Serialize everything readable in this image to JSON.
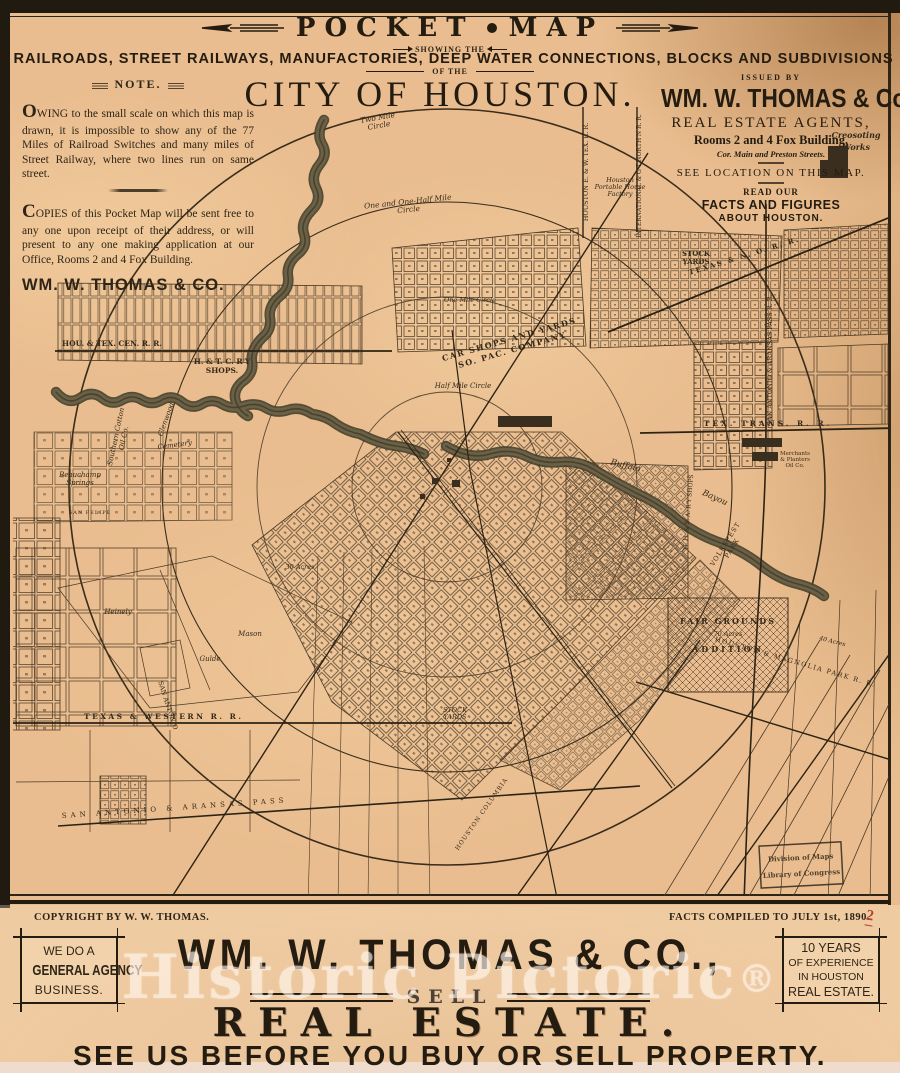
{
  "header": {
    "title_left": "POCKET",
    "title_right": "MAP",
    "showing": "SHOWING THE",
    "subtitle": "RAILROADS, STREET RAILWAYS, MANUFACTORIES, DEEP WATER CONNECTIONS, BLOCKS AND SUBDIVISIONS",
    "of_the": "OF THE",
    "city": "CITY OF HOUSTON."
  },
  "note": {
    "title": "NOTE.",
    "p1": "OWING to the small scale on which this map is drawn, it is impossible to show any of the 77 Miles of Railroad Switches and many miles of Street Railway, where two lines run on same street.",
    "p2": "COPIES of this Pocket Map will be sent free to any one upon receipt of their address, or will present to any one making application at our Office, Rooms 2 and 4 Fox Building.",
    "signature": "WM. W. THOMAS & CO."
  },
  "issuer": {
    "issued_by": "ISSUED BY",
    "name": "WM. W. THOMAS & Co.,",
    "agents": "REAL ESTATE AGENTS,",
    "rooms": "Rooms 2 and 4 Fox Building,",
    "corner": "Cor. Main and Preston Streets.",
    "see_location": "SEE LOCATION ON THIS MAP.",
    "read_our": "READ OUR",
    "facts": "FACTS AND FIGURES",
    "about": "ABOUT HOUSTON."
  },
  "map": {
    "labels": {
      "two_mile_1": "Two Mile",
      "two_mile_2": "Circle",
      "one_half_1": "One and One-Half Mile",
      "one_half_2": "Circle",
      "one_mile": "One Mile Circle",
      "half_mile": "Half Mile Circle",
      "beauchamp_1": "Beauchamp",
      "beauchamp_2": "Springs",
      "hou_tex_cen": "HOU. & TEX. CEN. R. R.",
      "htc_1": "H. & T. C. R'Y",
      "htc_2": "SHOPS.",
      "cotton_1": "Southern Cotton",
      "cotton_2": "Oil Co.",
      "glenwood": "Glenwood",
      "cemetery": "Cemetery",
      "car_1": "CAR SHOPS AND YARDS",
      "car_2": "SO. PAC. COMPANY",
      "stock_e_1": "STOCK",
      "stock_e_2": "YARDS",
      "creosoting_1": "Creosoting",
      "creosoting_2": "Works",
      "tex_trans": "TEX. TRANS. R. R.",
      "tex_no": "TEXAS & N. O. R. R.",
      "sa_ap": "SAN ANTONIO & ARANSAS PASS R. R.",
      "hou_ew": "HOUSTON E. & W. TEX. R. R.",
      "int_gn": "INTERNATIONAL & G'T NORTH'N R. R.",
      "portable_1": "Houston",
      "portable_2": "Portable House",
      "portable_3": "Factory",
      "buffalo": "Buffalo",
      "bayou": "Bayou",
      "merch_1": "Merchants",
      "merch_2": "& Planters",
      "merch_3": "Oil Co.",
      "ghsa": "G. H. & S. A. R'Y SHOPS",
      "volk_1": "VOLKSFEST",
      "volk_2": "PARK",
      "hou_mag": "HOUSTON & MAGNOLIA PARK R. R.",
      "fair_1": "FAIR GROUNDS",
      "fair_acres": "70 Acres",
      "fair_2": "ADDITION",
      "tex_west": "TEXAS & WESTERN R. R.",
      "stock_w_1": "STOCK",
      "stock_w_2": "YARDS",
      "san_antonio": "SAN ANTONIO",
      "sa_pass": "SAN ANTONIO & ARANSAS PASS",
      "heinely": "Heinely",
      "mason": "Mason",
      "gulde": "Gulde",
      "san_felipe": "SAN FELIPE",
      "hou_col": "HOUSTON COLUMBIA",
      "acres_30": "30 Acres",
      "acres_40": "40 Acres"
    },
    "stamp": {
      "line1": "Division of Maps",
      "line2": "Library of Congress"
    }
  },
  "footer": {
    "copyright": "COPYRIGHT BY W. W. THOMAS.",
    "facts": "FACTS COMPILED TO JULY 1st, 1890.",
    "red_mark": "2"
  },
  "ad": {
    "left_box": {
      "l1": "WE DO A",
      "l2": "GENERAL AGENCY",
      "l3": "BUSINESS."
    },
    "right_box": {
      "l1": "10 YEARS",
      "l2": "OF EXPERIENCE",
      "l3": "IN HOUSTON",
      "l4": "REAL ESTATE."
    },
    "company": "WM. W. THOMAS & CO.,",
    "sell": "SELL",
    "product": "REAL ESTATE.",
    "tagline": "SEE US BEFORE YOU BUY OR SELL PROPERTY."
  },
  "watermark": {
    "text": "Historic Pictoric",
    "reg": "®"
  }
}
